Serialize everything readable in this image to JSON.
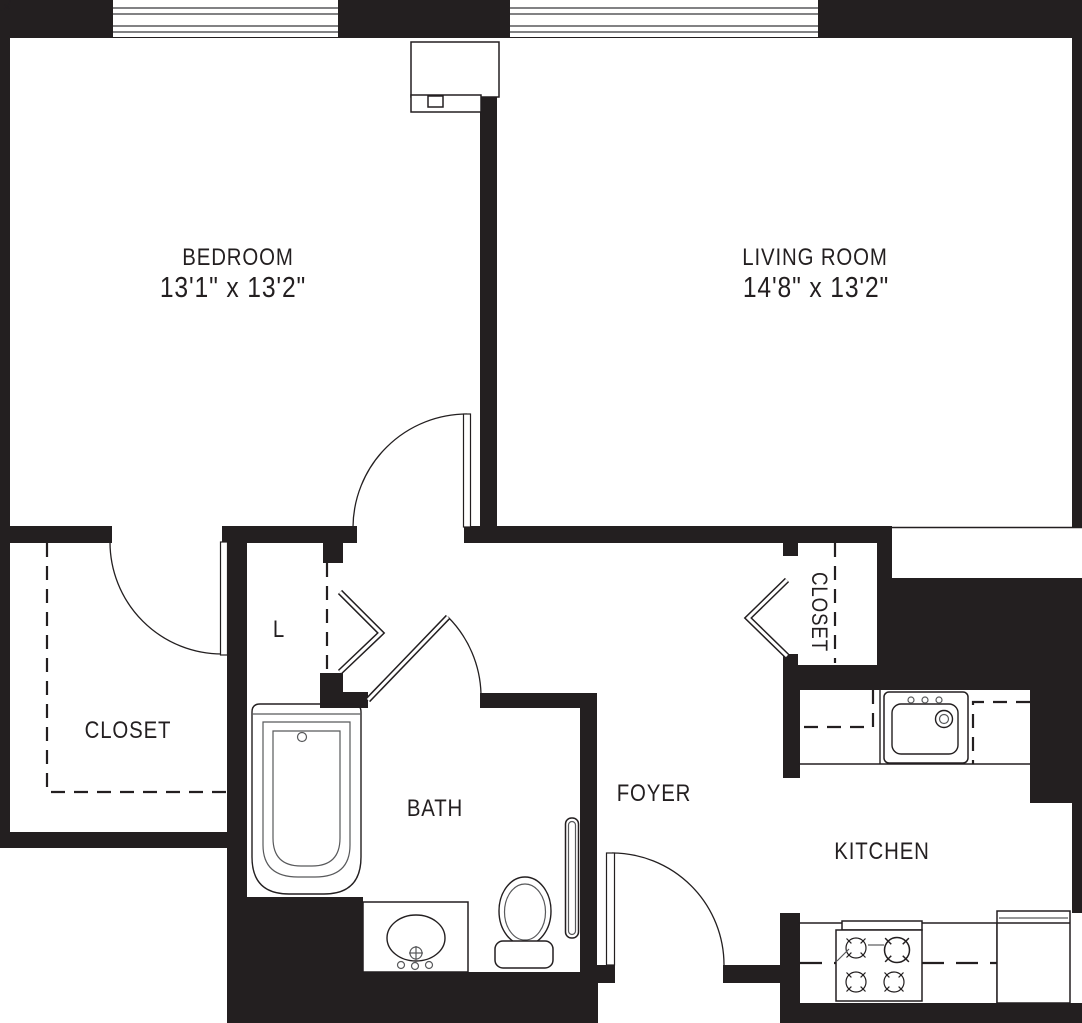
{
  "colors": {
    "ink": "#231f20",
    "line_gray": "#58595b",
    "background": "#ffffff"
  },
  "rooms": {
    "bedroom": {
      "label": "BEDROOM",
      "dimensions": "13'1\" x 13'2\""
    },
    "living_room": {
      "label": "LIVING ROOM",
      "dimensions": "14'8\" x 13'2\""
    },
    "closet": {
      "label": "CLOSET"
    },
    "linen_closet": {
      "label": "L"
    },
    "bath": {
      "label": "BATH"
    },
    "foyer": {
      "label": "FOYER"
    },
    "hall_closet": {
      "label": "CLOSET"
    },
    "kitchen": {
      "label": "KITCHEN"
    }
  }
}
